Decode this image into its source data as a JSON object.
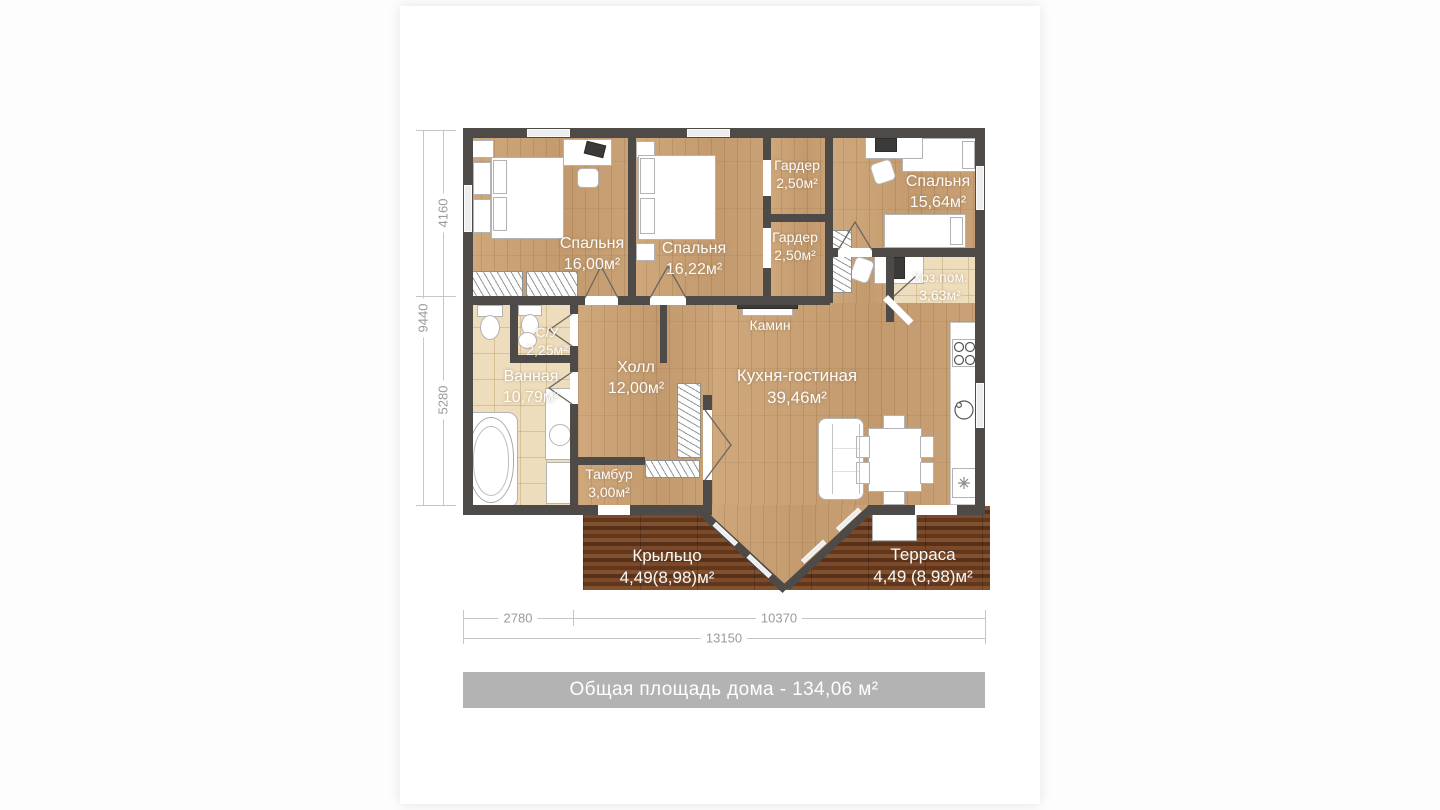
{
  "plan": {
    "rooms": [
      {
        "id": "bedroom-1",
        "name": "Спальня",
        "area": "16,00м²"
      },
      {
        "id": "bedroom-2",
        "name": "Спальня",
        "area": "16,22м²"
      },
      {
        "id": "wardrobe-top",
        "name": "Гардер",
        "area": "2,50м²"
      },
      {
        "id": "wardrobe-bottom",
        "name": "Гардер",
        "area": "2,50м²"
      },
      {
        "id": "bedroom-3",
        "name": "Спальня",
        "area": "15,64м²"
      },
      {
        "id": "utility-room",
        "name": "Хоз.пом.",
        "area": "3,63м²"
      },
      {
        "id": "wc",
        "name": "С/У",
        "area": "2,25м²"
      },
      {
        "id": "bathroom",
        "name": "Ванная",
        "area": "10,79м²"
      },
      {
        "id": "hall",
        "name": "Холл",
        "area": "12,00м²"
      },
      {
        "id": "vestibule",
        "name": "Тамбур",
        "area": "3,00м²"
      },
      {
        "id": "kitchen-living",
        "name": "Кухня-гостиная",
        "area": "39,46м²"
      },
      {
        "id": "porch",
        "name": "Крыльцо",
        "area": "4,49(8,98)м²"
      },
      {
        "id": "terrace",
        "name": "Терраса",
        "area": "4,49 (8,98)м²"
      }
    ],
    "fireplace_label": "Камин",
    "dimensions": {
      "left_top": "4160",
      "left_total": "9440",
      "left_bottom": "5280",
      "bottom_left": "2780",
      "bottom_right": "10370",
      "bottom_total": "13150"
    },
    "footer_text": "Общая площадь дома - 134,06 м²",
    "colors": {
      "wall": "#4e4a47",
      "wood_floor": "#c9a176",
      "tile_floor": "#eeddbc",
      "deck": "#6e3f22",
      "footer_bg": "#b3b3b3",
      "dimension_text": "#9b9b9b"
    }
  }
}
